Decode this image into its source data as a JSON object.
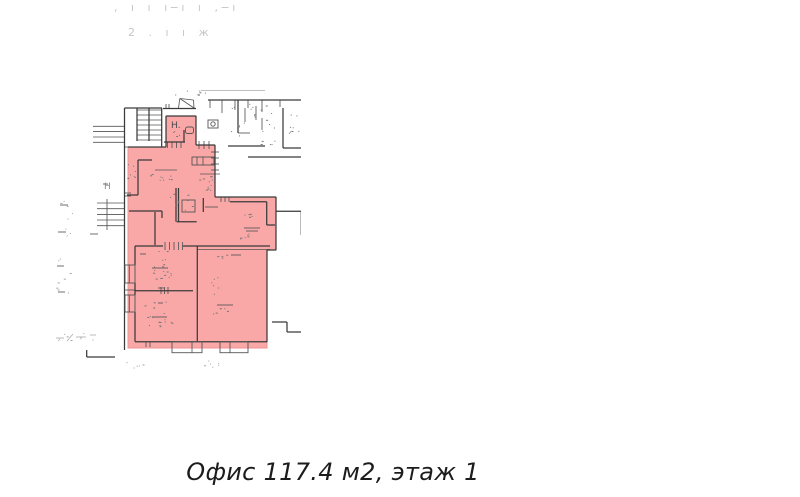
{
  "page": {
    "background": "#ffffff"
  },
  "header": {
    "line1": ", ı ı ı−ı ı ,−ı",
    "line2": "2 . ı ı ж"
  },
  "caption": {
    "text": "Офис 117.4 м2, этаж 1"
  },
  "plan": {
    "highlight_color": "#f9a7a7",
    "highlight_border": "#ef9393",
    "wall_color": "#3a3a3a",
    "detail_color": "#555555",
    "faint_color": "#aaaaaa",
    "speck_color": "#777777",
    "speck_faint_color": "#a5a5a5",
    "highlight_polygon": [
      [
        128,
        147
      ],
      [
        166,
        147
      ],
      [
        166,
        116
      ],
      [
        196,
        116
      ],
      [
        196,
        145
      ],
      [
        215,
        145
      ],
      [
        215,
        197
      ],
      [
        276,
        197
      ],
      [
        276,
        250
      ],
      [
        267,
        250
      ],
      [
        267,
        348
      ],
      [
        128,
        348
      ]
    ],
    "walls": [
      [
        124.5,
        108,
        162,
        108
      ],
      [
        124.5,
        108,
        124.5,
        350
      ],
      [
        137,
        108,
        137,
        141
      ],
      [
        149,
        108,
        149,
        141
      ],
      [
        161.7,
        108,
        161.7,
        147
      ],
      [
        128,
        147,
        166,
        147
      ],
      [
        166,
        116,
        166,
        147
      ],
      [
        166,
        116,
        196,
        116
      ],
      [
        196,
        116,
        196,
        145
      ],
      [
        163,
        108.5,
        196,
        108.5
      ],
      [
        164,
        142,
        185,
        142
      ],
      [
        184,
        130,
        184,
        142
      ],
      [
        196,
        145,
        215,
        145
      ],
      [
        215,
        145,
        215,
        197
      ],
      [
        215,
        197,
        276,
        197
      ],
      [
        276,
        197,
        276,
        250
      ],
      [
        267,
        250,
        276,
        250
      ],
      [
        267,
        250,
        267,
        342
      ],
      [
        135,
        341.7,
        267,
        341.7
      ],
      [
        135,
        246,
        135,
        265
      ],
      [
        135,
        283,
        135,
        295
      ],
      [
        135,
        312,
        135,
        341.7
      ],
      [
        135,
        246,
        163,
        246
      ],
      [
        183,
        246,
        270,
        246
      ],
      [
        197.3,
        246,
        197.3,
        341.7
      ],
      [
        135,
        290.7,
        193,
        290.7
      ],
      [
        138,
        160,
        152,
        160
      ],
      [
        138,
        160,
        138,
        195
      ],
      [
        127,
        195,
        138,
        195
      ],
      [
        129,
        211,
        162,
        211
      ],
      [
        162,
        211,
        162,
        218
      ],
      [
        155,
        212,
        155,
        245
      ],
      [
        176,
        188,
        176,
        221.7
      ],
      [
        178.5,
        188,
        178.5,
        221.7
      ],
      [
        176.7,
        221.7,
        196.7,
        221.7
      ],
      [
        203.3,
        198,
        203.3,
        212
      ],
      [
        230,
        201.7,
        266.7,
        201.7
      ],
      [
        266.7,
        201.7,
        266.7,
        225
      ],
      [
        266.7,
        225,
        275,
        225
      ],
      [
        208,
        100,
        301,
        100
      ],
      [
        238,
        100,
        238,
        133
      ],
      [
        228,
        146,
        265,
        146
      ],
      [
        248,
        157,
        301,
        157
      ],
      [
        283,
        108,
        283,
        148
      ],
      [
        283,
        148,
        301,
        148
      ],
      [
        276,
        211.3,
        301,
        211.3
      ],
      [
        272,
        322,
        287,
        322
      ],
      [
        287,
        322,
        287,
        332
      ],
      [
        287,
        332,
        301,
        332
      ],
      [
        86.7,
        350,
        86.7,
        357
      ],
      [
        86.7,
        357,
        115,
        357
      ]
    ],
    "thin": [
      [
        137,
        110,
        161.7,
        110
      ],
      [
        137,
        115,
        161.7,
        115
      ],
      [
        137,
        120,
        161.7,
        120
      ],
      [
        137,
        125,
        161.7,
        125
      ],
      [
        137,
        130,
        161.7,
        130
      ],
      [
        137,
        135,
        161.7,
        135
      ],
      [
        137,
        140,
        161.7,
        140
      ],
      [
        167.5,
        142,
        167.5,
        148
      ],
      [
        172,
        142,
        172,
        148
      ],
      [
        176.5,
        142,
        176.5,
        148
      ],
      [
        181,
        142,
        181,
        148
      ],
      [
        199,
        141,
        199,
        149
      ],
      [
        204,
        141,
        204,
        149
      ],
      [
        209,
        141,
        209,
        149
      ],
      [
        211,
        152,
        219,
        152
      ],
      [
        211,
        158,
        219,
        158
      ],
      [
        211,
        164,
        219,
        164
      ],
      [
        211,
        170,
        219,
        170
      ],
      [
        197,
        157,
        197,
        165
      ],
      [
        203,
        157,
        203,
        165
      ],
      [
        221,
        197,
        221,
        202
      ],
      [
        225,
        197,
        225,
        202
      ],
      [
        229,
        197,
        229,
        202
      ],
      [
        165,
        242,
        165,
        250
      ],
      [
        169.5,
        242,
        169.5,
        250
      ],
      [
        174,
        242,
        174,
        250
      ],
      [
        178.5,
        242,
        178.5,
        250
      ],
      [
        182.5,
        242,
        182.5,
        250
      ],
      [
        161,
        287,
        161,
        294
      ],
      [
        164.5,
        287,
        164.5,
        294
      ],
      [
        168,
        287,
        168,
        294
      ],
      [
        129.3,
        265,
        129.3,
        283
      ],
      [
        129.3,
        295,
        129.3,
        312
      ],
      [
        192,
        341.7,
        192,
        352.7
      ],
      [
        230,
        341.7,
        230,
        352.7
      ],
      [
        146,
        341.7,
        146,
        347
      ],
      [
        150,
        341.7,
        150,
        347
      ],
      [
        124.5,
        147,
        128,
        147
      ],
      [
        125,
        193,
        131,
        193
      ],
      [
        125,
        196,
        131,
        196
      ],
      [
        125,
        290,
        135,
        290
      ],
      [
        93,
        126.3,
        124.5,
        126.3
      ],
      [
        93,
        131.6,
        124.5,
        131.6
      ],
      [
        93,
        137,
        124.5,
        137
      ],
      [
        93,
        142.3,
        124.5,
        142.3
      ],
      [
        97,
        203,
        124.5,
        203
      ],
      [
        97,
        208.7,
        124.5,
        208.7
      ],
      [
        97,
        214.4,
        124.5,
        214.4
      ],
      [
        97,
        220,
        124.5,
        220
      ],
      [
        97,
        225.7,
        124.5,
        225.7
      ],
      [
        107,
        199,
        107,
        230
      ],
      [
        210,
        100,
        210,
        108
      ],
      [
        222,
        100,
        222,
        113
      ],
      [
        235,
        100,
        235,
        110
      ],
      [
        248,
        100,
        248,
        108
      ],
      [
        262,
        100,
        262,
        112
      ],
      [
        280,
        100,
        280,
        107
      ],
      [
        245,
        108,
        245,
        122
      ],
      [
        256,
        106,
        256,
        120
      ],
      [
        262,
        118,
        262,
        130
      ],
      [
        238,
        133,
        250,
        133
      ],
      [
        166,
        104,
        166,
        108.5
      ],
      [
        169,
        104,
        169,
        108.5
      ],
      [
        178.5,
        108,
        179.8,
        98.5
      ],
      [
        179.8,
        98.5,
        193.5,
        100
      ],
      [
        193.5,
        100,
        194,
        108
      ],
      [
        179.8,
        98.5,
        194,
        108
      ],
      [
        197,
        249.5,
        270,
        249.5
      ],
      [
        155,
        170,
        177,
        170
      ],
      [
        200,
        174,
        220,
        174
      ],
      [
        244,
        228,
        260,
        228
      ],
      [
        246,
        231,
        258,
        231
      ],
      [
        152,
        268,
        168,
        268
      ],
      [
        152,
        317,
        167,
        317
      ],
      [
        217,
        305,
        233,
        305
      ],
      [
        231,
        255,
        241,
        255
      ],
      [
        158,
        288,
        164,
        288
      ],
      [
        140,
        254,
        146,
        254
      ],
      [
        158,
        303,
        163,
        303
      ],
      [
        205,
        207,
        218,
        207
      ],
      [
        90,
        234,
        98,
        234
      ],
      [
        60,
        205,
        68,
        205
      ],
      [
        58,
        232,
        66,
        232
      ],
      [
        57,
        266,
        64,
        266
      ],
      [
        58,
        292,
        65,
        292
      ],
      [
        103,
        184,
        108,
        184
      ]
    ],
    "faint": [
      [
        201,
        90.5,
        265,
        90.5
      ],
      [
        300.5,
        212,
        300.5,
        235
      ],
      [
        56,
        338,
        64,
        338
      ],
      [
        67,
        341,
        73,
        334
      ],
      [
        76,
        337,
        86,
        337
      ],
      [
        90,
        335,
        96,
        335
      ]
    ],
    "rects": [
      {
        "x": 182,
        "y": 200,
        "w": 13,
        "h": 12
      },
      {
        "x": 185.5,
        "y": 127,
        "w": 8,
        "h": 6.5,
        "r": 2
      },
      {
        "x": 192,
        "y": 157,
        "w": 22,
        "h": 8
      },
      {
        "x": 208,
        "y": 120,
        "w": 10,
        "h": 8
      },
      {
        "x": 125,
        "y": 265,
        "w": 10,
        "h": 18
      },
      {
        "x": 125,
        "y": 295,
        "w": 10,
        "h": 17
      },
      {
        "x": 172,
        "y": 341.7,
        "w": 30,
        "h": 11
      },
      {
        "x": 220,
        "y": 341.7,
        "w": 28,
        "h": 11
      }
    ],
    "circles": [
      {
        "cx": 213,
        "cy": 124,
        "r": 2.2
      }
    ],
    "specks": [
      {
        "x": 230,
        "y": 103,
        "w": 45,
        "h": 42,
        "n": 26
      },
      {
        "x": 288,
        "y": 112,
        "w": 12,
        "h": 26,
        "n": 8
      },
      {
        "x": 127,
        "y": 160,
        "w": 10,
        "h": 18,
        "n": 7
      },
      {
        "x": 150,
        "y": 172,
        "w": 24,
        "h": 8,
        "n": 9
      },
      {
        "x": 199,
        "y": 176,
        "w": 22,
        "h": 7,
        "n": 7
      },
      {
        "x": 168,
        "y": 193,
        "w": 24,
        "h": 20,
        "n": 9
      },
      {
        "x": 204,
        "y": 183,
        "w": 9,
        "h": 9,
        "n": 5
      },
      {
        "x": 238,
        "y": 210,
        "w": 14,
        "h": 7,
        "n": 5
      },
      {
        "x": 240,
        "y": 233,
        "w": 17,
        "h": 6,
        "n": 6
      },
      {
        "x": 143,
        "y": 250,
        "w": 28,
        "h": 26,
        "n": 10
      },
      {
        "x": 146,
        "y": 270,
        "w": 26,
        "h": 9,
        "n": 8
      },
      {
        "x": 143,
        "y": 298,
        "w": 28,
        "h": 26,
        "n": 10
      },
      {
        "x": 147,
        "y": 319,
        "w": 25,
        "h": 8,
        "n": 8
      },
      {
        "x": 211,
        "y": 277,
        "w": 7,
        "h": 17,
        "n": 6
      },
      {
        "x": 213,
        "y": 307,
        "w": 20,
        "h": 7,
        "n": 6
      },
      {
        "x": 217,
        "y": 253,
        "w": 10,
        "h": 5,
        "n": 4
      },
      {
        "x": 172,
        "y": 130,
        "w": 8,
        "h": 6,
        "n": 4
      },
      {
        "x": 169,
        "y": 88,
        "w": 38,
        "h": 7,
        "n": 7
      },
      {
        "x": 57,
        "y": 200,
        "w": 16,
        "h": 36,
        "n": 8,
        "f": 1
      },
      {
        "x": 56,
        "y": 258,
        "w": 15,
        "h": 38,
        "n": 8,
        "f": 1
      },
      {
        "x": 55,
        "y": 333,
        "w": 42,
        "h": 9,
        "n": 9,
        "f": 1
      },
      {
        "x": 126,
        "y": 361,
        "w": 18,
        "h": 7,
        "n": 5,
        "f": 1
      },
      {
        "x": 197,
        "y": 360,
        "w": 24,
        "h": 9,
        "n": 6,
        "f": 1
      }
    ],
    "labels": [
      {
        "text": "Н.",
        "x": 171,
        "y": 128,
        "size": 9,
        "color": "#4a4a4a"
      },
      {
        "text": "Н",
        "x": 104,
        "y": 189,
        "size": 9,
        "color": "#8a8a8a"
      }
    ]
  }
}
